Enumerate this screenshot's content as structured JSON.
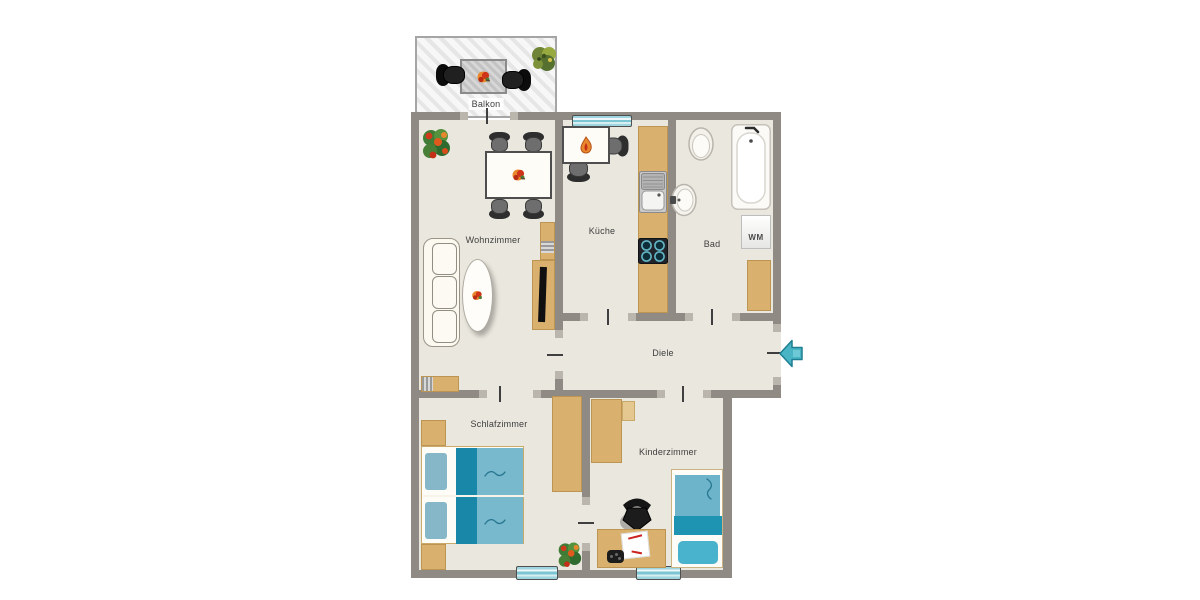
{
  "floorplan": {
    "rooms": {
      "balkon": "Balkon",
      "wohnzimmer": "Wohnzimmer",
      "kueche": "Küche",
      "bad": "Bad",
      "diele": "Diele",
      "schlafzimmer": "Schlafzimmer",
      "kinderzimmer": "Kinderzimmer"
    },
    "labels": {
      "washing_machine": "WM"
    },
    "colors": {
      "wall": "#8f8b84",
      "floor": "#eae7de",
      "furniture_wood": "#d9b06e",
      "bed_teal": "#79b9cd",
      "bed_teal_dark": "#1987a7",
      "pillow_teal": "#86b7c8",
      "window_teal": "#9ed5de",
      "entry_arrow": "#49b5c4",
      "balcony_stripe": "#e6e6e6"
    }
  }
}
